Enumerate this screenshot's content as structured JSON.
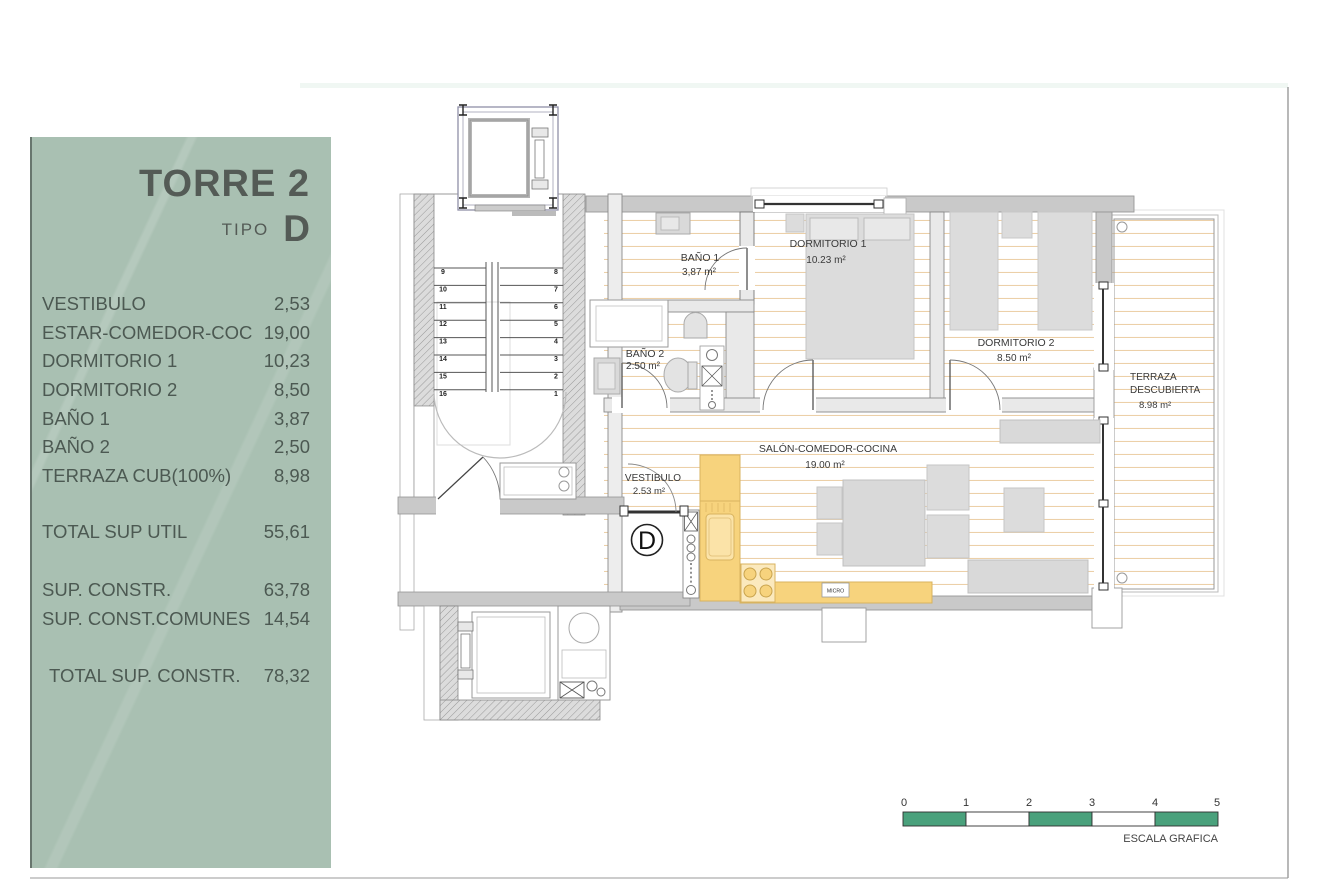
{
  "panel": {
    "title": "TORRE 2",
    "tipo_label": "TIPO",
    "tipo_value": "D",
    "rows": [
      {
        "label": "VESTIBULO",
        "value": "2,53"
      },
      {
        "label": "ESTAR-COMEDOR-COC",
        "value": "19,00"
      },
      {
        "label": "DORMITORIO 1",
        "value": "10,23"
      },
      {
        "label": "DORMITORIO 2",
        "value": "8,50"
      },
      {
        "label": "BAÑO 1",
        "value": "3,87"
      },
      {
        "label": "BAÑO 2",
        "value": "2,50"
      },
      {
        "label": "TERRAZA CUB(100%)",
        "value": "8,98"
      }
    ],
    "total_util": {
      "label": "TOTAL SUP UTIL",
      "value": "55,61"
    },
    "constr_rows": [
      {
        "label": "SUP. CONSTR.",
        "value": "63,78"
      },
      {
        "label": "SUP. CONST.COMUNES",
        "value": "14,54"
      }
    ],
    "total_constr": {
      "label": "TOTAL SUP. CONSTR.",
      "value": "78,32"
    }
  },
  "plan": {
    "unit_letter": "D",
    "rooms": {
      "bano1": {
        "name": "BAÑO 1",
        "area": "3,87 m²"
      },
      "dormitorio1": {
        "name": "DORMITORIO 1",
        "area": "10.23 m²"
      },
      "dormitorio2": {
        "name": "DORMITORIO 2",
        "area": "8.50 m²"
      },
      "bano2": {
        "name": "BAÑO 2",
        "area": "2.50 m²"
      },
      "salon": {
        "name": "SALÓN-COMEDOR-COCINA",
        "area": "19.00 m²"
      },
      "vestibulo": {
        "name": "VESTIBULO",
        "area": "2.53 m²"
      },
      "terraza": {
        "name_line1": "TERRAZA",
        "name_line2": "DESCUBIERTA",
        "area": "8.98 m²"
      }
    },
    "kitchen": {
      "micro_label": "MICRO"
    },
    "stair_steps_left": [
      "9",
      "10",
      "11",
      "12",
      "13",
      "14",
      "15",
      "16"
    ],
    "stair_steps_right": [
      "8",
      "7",
      "6",
      "5",
      "4",
      "3",
      "2",
      "1"
    ]
  },
  "scale_bar": {
    "ticks": [
      "0",
      "1",
      "2",
      "3",
      "4",
      "5"
    ],
    "caption": "ESCALA GRAFICA"
  },
  "colors": {
    "panel_bg": "#a9c0b2",
    "scale_green": "#4aa17c",
    "kitchen_yellow": "#f7d37d",
    "wood_line": "#ecd0a8",
    "wall_gray": "#c9c9c9"
  }
}
